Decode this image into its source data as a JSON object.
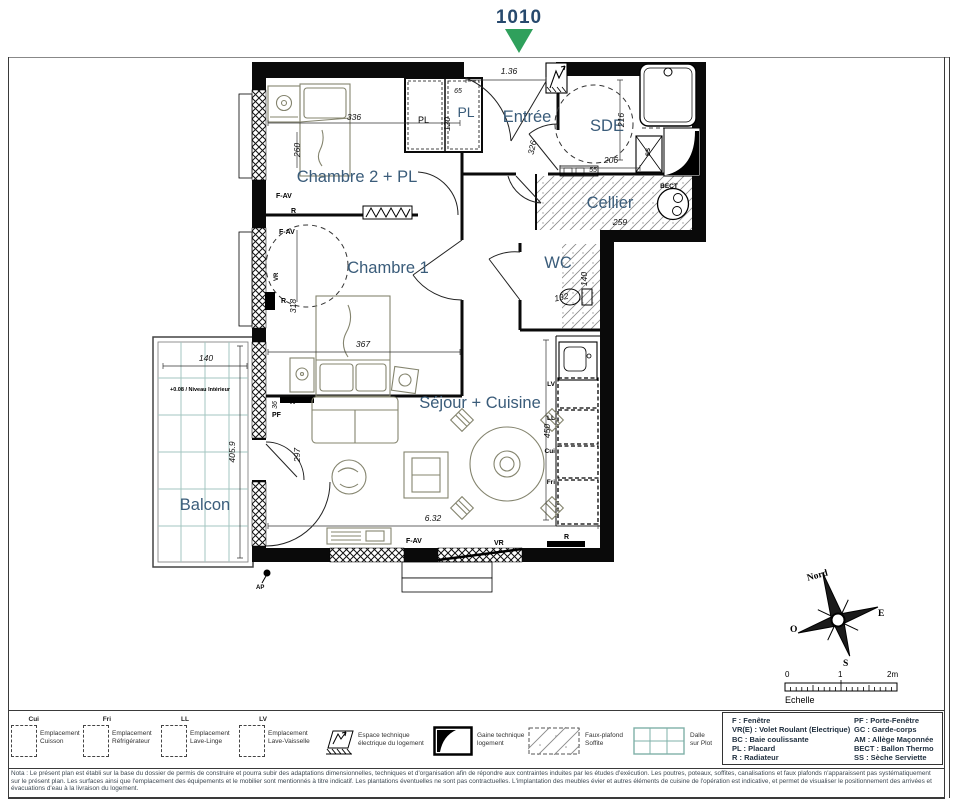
{
  "header": {
    "lot_number": "1010"
  },
  "colors": {
    "room_label_blue": "#3A5C7A",
    "lot_navy": "#27496D",
    "arrow_green": "#2FA05C",
    "balcony_teal": "#A3C6C0"
  },
  "plan": {
    "rooms": {
      "entree": "Entrée",
      "sde": "SDE",
      "cellier": "Cellier",
      "wc": "WC",
      "chambre2": "Chambre 2 + PL",
      "chambre1": "Chambre 1",
      "sejour": "Séjour + Cuisine",
      "balcon": "Balcon",
      "placard": "PL"
    },
    "dims": {
      "entrance": "1.36",
      "pl_depth": "65",
      "pl_width": "120",
      "ch2_w": "336",
      "ch2_h": "260",
      "entree_h": "326",
      "sde_h": "216",
      "sde_w": "206",
      "sde_w2": "55",
      "cellier_w": "259",
      "ch1_w": "367",
      "ch1_h": "318",
      "wc_w": "132",
      "wc_h": "140",
      "kitchen_h": "450",
      "sejour_w": "6.32",
      "sejour_h": "297",
      "door_w": "36",
      "balcon_w": "140",
      "balcon_h": "405.9"
    },
    "annotations": {
      "fav": "F-AV",
      "vr": "VR",
      "r": "R",
      "pf": "PF",
      "pl": "PL",
      "ss": "SS",
      "bect": "BECT",
      "lv": "LV",
      "ll": "LL",
      "cui": "Cui",
      "fri": "Fri",
      "niveau": "+0.08 / Niveau Intérieur",
      "ap": "AP"
    }
  },
  "compass": {
    "north": "Nord",
    "east": "E",
    "west": "O",
    "south": "S"
  },
  "scalebar": {
    "zero": "0",
    "one": "1",
    "two": "2m",
    "label": "Echelle"
  },
  "legend": {
    "placements": [
      {
        "abbr": "Cui",
        "line1": "Emplacement",
        "line2": "Cuisson"
      },
      {
        "abbr": "Fri",
        "line1": "Emplacement",
        "line2": "Réfrigérateur"
      },
      {
        "abbr": "LL",
        "line1": "Emplacement",
        "line2": "Lave-Linge"
      },
      {
        "abbr": "LV",
        "line1": "Emplacement",
        "line2": "Lave-Vaisselle"
      }
    ],
    "symbols": [
      {
        "line1": "Espace technique",
        "line2": "électrique du logement"
      },
      {
        "line1": "Gaine technique",
        "line2": "logement"
      },
      {
        "line1": "Faux-plafond",
        "line2": "Soffite"
      },
      {
        "line1": "Dalle",
        "line2": "sur Plot"
      }
    ],
    "abbreviations_col1": [
      "F : Fenêtre",
      "VR(E) : Volet Roulant (Electrique)",
      "BC : Baie coulissante",
      "PL : Placard",
      "R : Radiateur"
    ],
    "abbreviations_col2": [
      "PF : Porte-Fenêtre",
      "GC : Garde-corps",
      "AM : Allège Maçonnée",
      "BECT : Ballon Thermo",
      "SS : Sèche Serviette"
    ]
  },
  "note": "Nota : Le présent plan est établi sur la base du dossier de permis de construire et pourra subir des adaptations dimensionnelles, techniques et d'organisation afin de répondre aux contraintes induites par les études d'exécution. Les poutres, poteaux, soffites, canalisations et faux plafonds n'apparaissent pas systématiquement sur le présent plan. Les surfaces ainsi que l'emplacement des équipements et le mobilier sont mentionnés à titre indicatif. Les plantations éventuelles ne sont pas contractuelles. L'implantation des meubles évier et autres éléments de cuisine de l'opération est indicative, et permet de visualiser le positionnement des arrivées et évacuations d'eau à la livraison du logement."
}
